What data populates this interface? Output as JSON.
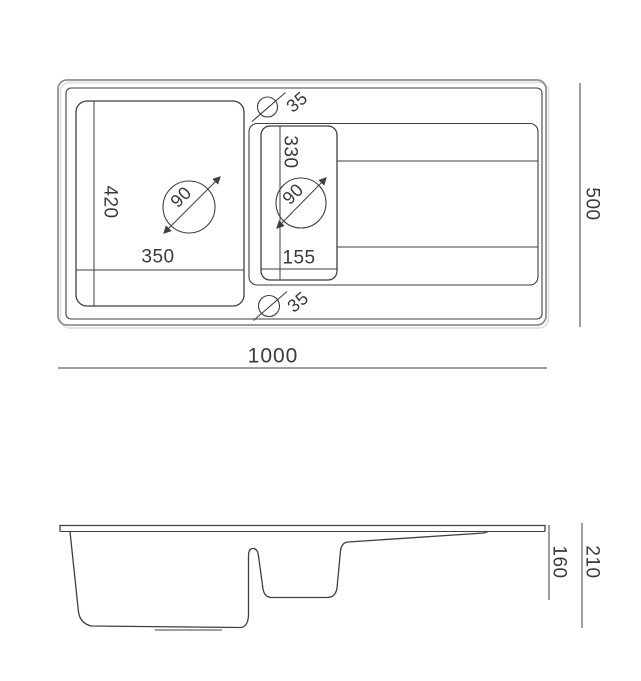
{
  "colors": {
    "line": "#3f3f3f",
    "outer_line": "#8f8f8f",
    "text": "#3a3a3a",
    "background": "#ffffff"
  },
  "top_view": {
    "overall_width": "1000",
    "overall_depth": "500",
    "main_bowl": {
      "width": "350",
      "length": "420",
      "drain_diameter": "90"
    },
    "half_bowl": {
      "width": "155",
      "length": "330",
      "drain_diameter": "90"
    },
    "tap_hole_top_diameter": "35",
    "tap_hole_bottom_diameter": "35"
  },
  "section_view": {
    "overall_height": "210",
    "bowl_depth": "160"
  }
}
